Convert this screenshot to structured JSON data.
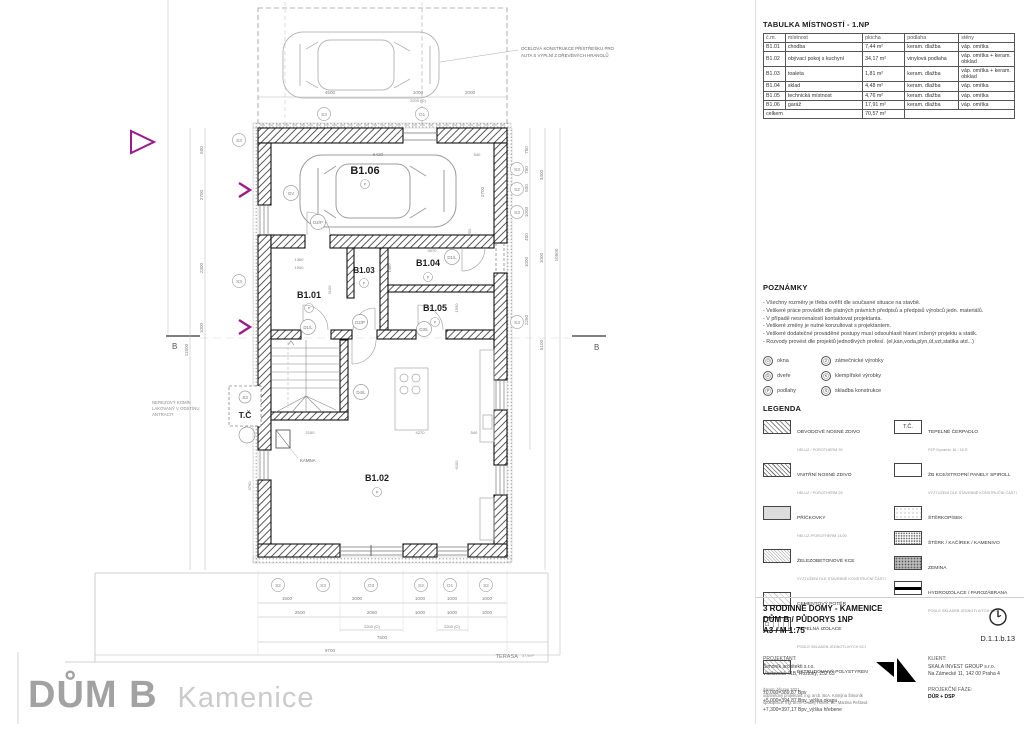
{
  "plan": {
    "carport_note_line1": "OCELOVÁ KONSTRUKCE PŘÍSTŘEŠKU PRO",
    "carport_note_line2": "AUTA S VÝPLNÍ Z DŘEVĚNÝCH HRANOLŮ",
    "chimney_note_line1": "NEREZOVÝ KOMÍN",
    "chimney_note_line2": "LAKOVANÝ V ODSTÍNU",
    "chimney_note_line3": "ANTRACIT",
    "heat_pump_label": "T.Č",
    "stove_label": "KAMNA",
    "terrace_label": "TERASA",
    "terrace_area": "37,9m²",
    "section_label": "B",
    "room_symbol": "P",
    "rooms": {
      "garage": "B1.06",
      "hall": "B1.01",
      "living": "B1.02",
      "toilet": "B1.03",
      "storage": "B1.04",
      "utility": "B1.05"
    },
    "markers": {
      "s2": "S2",
      "s3": "S3",
      "o1": "O1",
      "o3": "O3",
      "gv": "GV",
      "d1l": "D1/L",
      "d2p": "D2/P",
      "d3l": "D3/L",
      "d4l": "D4/L"
    },
    "dims": {
      "top": [
        "4500",
        "1000",
        "2000"
      ],
      "top_sub": "2200 (O)",
      "left": [
        "500",
        "2700",
        "2300",
        "1000"
      ],
      "left_total": "11500",
      "right_a": [
        "750",
        "750",
        "500",
        "1000",
        "400",
        "1000",
        "2250"
      ],
      "right_b": [
        "3400",
        "1000",
        "5100"
      ],
      "right_total": "10500",
      "garage_w": "6420",
      "garage_h": "2700",
      "garage_off1": "540",
      "garage_off2": "250",
      "mid": [
        "1360",
        "1900",
        "3100",
        "3070",
        "1460",
        "1550"
      ],
      "living": [
        "2150",
        "4270",
        "540",
        "6150",
        "3760"
      ],
      "bottom1": [
        "1500",
        "3000",
        "1000",
        "1000",
        "1000"
      ],
      "bottom2": [
        "2500",
        "2080",
        "1000",
        "1000",
        "1000"
      ],
      "bottom3a": "2200 (O)",
      "bottom3b": "2200 (O)",
      "bottom4": "7500",
      "bottom5": "9700"
    }
  },
  "room_table": {
    "title": "TABULKA MÍSTNOSTÍ - 1.NP",
    "headers": [
      "č.m.",
      "místnost",
      "plocha",
      "podlaha",
      "stěny"
    ],
    "rows": [
      [
        "B1.01",
        "chodba",
        "7,44 m²",
        "keram. dlažba",
        "váp. omítka"
      ],
      [
        "B1.02",
        "obývací pokoj s kuchyní",
        "34,17 m²",
        "vinylová podlaha",
        "váp. omítka + keram. obklad"
      ],
      [
        "B1.03",
        "toaleta",
        "1,81 m²",
        "keram. dlažba",
        "váp. omítka + keram. obklad"
      ],
      [
        "B1.04",
        "sklad",
        "4,48 m²",
        "keram. dlažba",
        "váp. omítka"
      ],
      [
        "B1.05",
        "technická místnost",
        "4,76 m²",
        "keram. dlažba",
        "váp. omítka"
      ],
      [
        "B1.06",
        "garáž",
        "17,91 m²",
        "keram. dlažba",
        "váp. omítka"
      ]
    ],
    "total_label": "celkem",
    "total_value": "70,57 m²"
  },
  "notes": {
    "title": "POZNÁMKY",
    "items": [
      "Všechny rozměry je třeba ověřit dle současné situace na stavbě.",
      "Veškeré práce provádět dle platných právních předpisů a předpisů výrobců jedn. materiálů.",
      "V případě nesrovnalostí kontaktovat projektanta.",
      "Veškeré změny je nutné konzultovat s projektantem.",
      "Veškeré dodatečné prováděné postupy musí odsouhlasit hlavní inženýr projektu a statik.",
      "Rozvody provést dle projektů jednotlivých profesí. (el,kan,voda,plyn,út,vzt,statika atd...)"
    ],
    "symbols": [
      {
        "k": "O",
        "label": "okna"
      },
      {
        "k": "Z",
        "label": "zámečnické výrobky"
      },
      {
        "k": "D",
        "label": "dveře"
      },
      {
        "k": "K",
        "label": "klempířské výrobky"
      },
      {
        "k": "P",
        "label": "podlahy"
      },
      {
        "k": "S",
        "label": "skladba konstrukce"
      }
    ]
  },
  "legend": {
    "title": "LEGENDA",
    "left": [
      {
        "name": "OBVODOVÉ NOSNÉ ZDIVO",
        "sub": "HELUZ / POROTHERM 30"
      },
      {
        "name": "VNITŘNÍ NOSNÉ ZDIVO",
        "sub": "HELUZ / POROTHERM 25"
      },
      {
        "name": "PŘÍČKOVKY",
        "sub": "HELUZ /POROTHERM 14/20"
      },
      {
        "name": "ŽELEZOBETONOVÉ KCE",
        "sub": "VYZTUŽENÍ DLE STAVEBNĚ KONSTRUČNÍ ČÁSTI"
      },
      {
        "name": "CEMENTOVÝ POTĚR",
        "sub": ""
      },
      {
        "name": "TEPELNÁ IZOLACE",
        "sub": "PODLE SKLADEB JEDNOTLIVÝCH KCÍ"
      },
      {
        "name": "EXTRUDOVANÝ POLYSTYREN",
        "sub": ""
      }
    ],
    "right": [
      {
        "name": "TEPELNÉ ČERPADLO",
        "sub": "PZP Dynamic 16 / 16 R",
        "swatch_label": "T.Č."
      },
      {
        "name": "ŽB KCE/STROPNÍ PANELY SPIROLL",
        "sub": "VYZTUŽENÍ DLE STAVEBNĚ KONSTRUČNÍ ČÁSTI"
      },
      {
        "name": "ŠTĚRKOPÍSEK",
        "sub": ""
      },
      {
        "name": "ŠTĚRK / KAČÍREK / KAMENIVO",
        "sub": ""
      },
      {
        "name": "ZEMINA",
        "sub": ""
      },
      {
        "name": "HYDROIZOLACE / PAROZÁBRANA",
        "sub": "PODLE SKLADEB JEDNOTLIVÝCH KCÍ"
      }
    ],
    "levels": [
      "±0,000=389,87 Bpv",
      "+5,000=394,87 Bpv_výška okapu",
      "+7,300=397,17 Bpv_výška hřebene"
    ]
  },
  "title_block": {
    "project": "3 RODINNÉ DOMY - KAMENICE",
    "drawing": "DŮM B / PŮDORYS 1NP",
    "format": "A3 / M 1:75",
    "number": "D.1.1.b.13",
    "designer_label": "PROJEKTANT:",
    "designer_name": "Šimoník architekti s.r.o.",
    "designer_address": "Václavská 41B, Roztoky, 252 63",
    "date_line": "datum: březen 2021",
    "responsible_line": "odpovědný projektant: ing. arch. BcA. Kristýna Šimoník",
    "collab_line": "spolupráce: ing. arch. Ondřej Honek, Bc. Martina Peštová",
    "client_label": "KLIENT:",
    "client_name": "SKALA INVEST GROUP s.r.o.",
    "client_address": "Na Zámecké 11, 142 00 Praha 4",
    "phase_label": "PROJEKČNÍ FÁZE:",
    "phase_value": "DÚR + DSP"
  },
  "footer": {
    "title": "DŮM B",
    "subtitle": "Kamenice"
  }
}
